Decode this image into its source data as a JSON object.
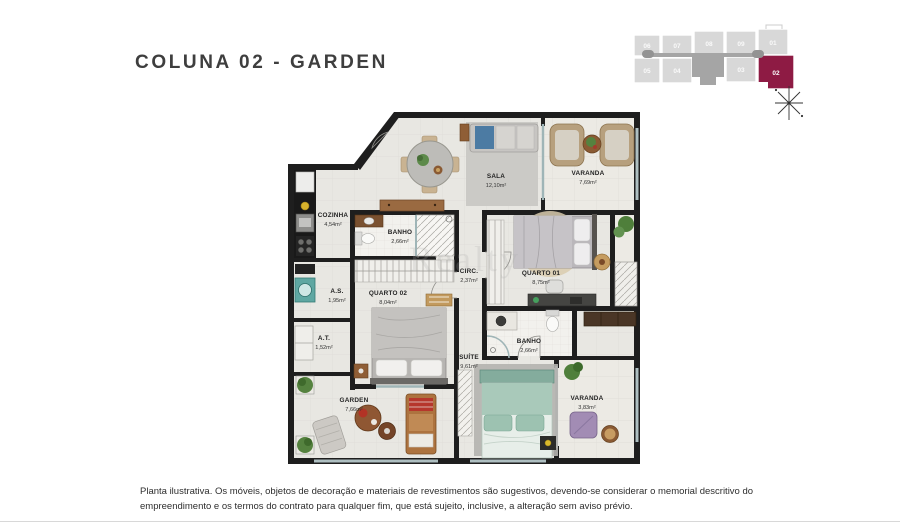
{
  "page": {
    "title": "COLUNA 02 - GARDEN",
    "watermark": "Realty",
    "disclaimer": "Planta ilustrativa. Os móveis, objetos de decoração e materiais de revestimentos são sugestivos, devendo-se considerar o memorial descritivo do empreendimento e os termos do contrato para qualquer fim, que está sujeito, inclusive, a alteração sem aviso prévio."
  },
  "keyplan": {
    "highlight_color": "#8e1b44",
    "cell_color": "#d8d8d8",
    "corridor_color": "#a5a5a5",
    "units": [
      {
        "label": "06",
        "highlighted": false
      },
      {
        "label": "07",
        "highlighted": false
      },
      {
        "label": "08",
        "highlighted": false
      },
      {
        "label": "09",
        "highlighted": false
      },
      {
        "label": "01",
        "highlighted": false
      },
      {
        "label": "05",
        "highlighted": false
      },
      {
        "label": "04",
        "highlighted": false
      },
      {
        "label": "03",
        "highlighted": false
      },
      {
        "label": "02",
        "highlighted": true
      }
    ]
  },
  "rooms": [
    {
      "name": "SALA",
      "area": "12,10m²"
    },
    {
      "name": "VARANDA",
      "area": "7,69m²"
    },
    {
      "name": "COZINHA",
      "area": "4,54m²"
    },
    {
      "name": "BANHO",
      "area": "2,66m²"
    },
    {
      "name": "A.S.",
      "area": "1,95m²"
    },
    {
      "name": "QUARTO 02",
      "area": "8,04m²"
    },
    {
      "name": "CIRC.",
      "area": "2,37m²"
    },
    {
      "name": "QUARTO 01",
      "area": "8,75m²"
    },
    {
      "name": "A.T.",
      "area": "1,52m²"
    },
    {
      "name": "SUÍTE",
      "area": "9,61m²"
    },
    {
      "name": "BANHO",
      "area": "2,66m²"
    },
    {
      "name": "GARDEN",
      "area": "7,66m²"
    },
    {
      "name": "VARANDA",
      "area": "3,83m²"
    }
  ]
}
